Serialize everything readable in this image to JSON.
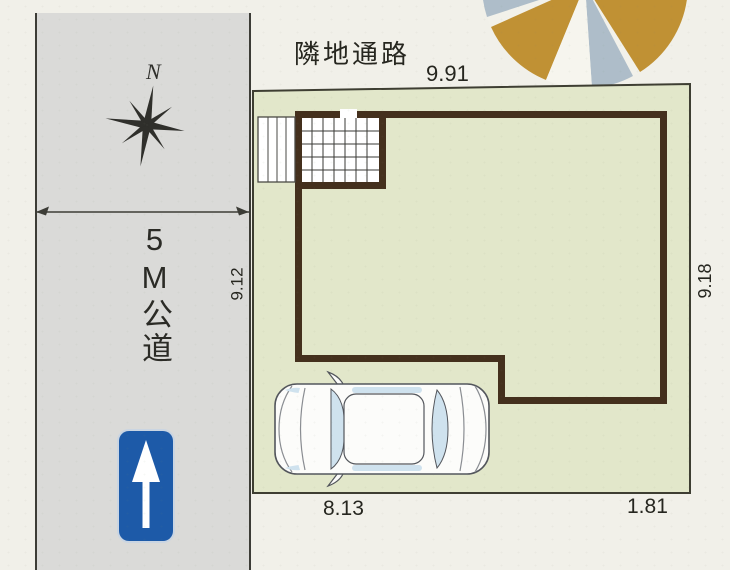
{
  "road": {
    "label": "5M公道"
  },
  "compass": {
    "north_label": "N"
  },
  "site": {
    "top_label": "隣地通路",
    "dimensions": {
      "top": "9.91",
      "right": "9.18",
      "left": "9.12",
      "bottom_left": "8.13",
      "bottom_right": "1.81"
    }
  },
  "colors": {
    "background": "#f1f0e9",
    "road_fill": "#dadad8",
    "lot_fill": "#e2e7ca",
    "building_wall": "#44301d",
    "building_interior": "#ffffff",
    "sign_blue": "#1d5aa8",
    "car_glass": "#cfe2ee",
    "tree_gold": "#c09134",
    "tree_gray_blue": "#aebdc9"
  }
}
